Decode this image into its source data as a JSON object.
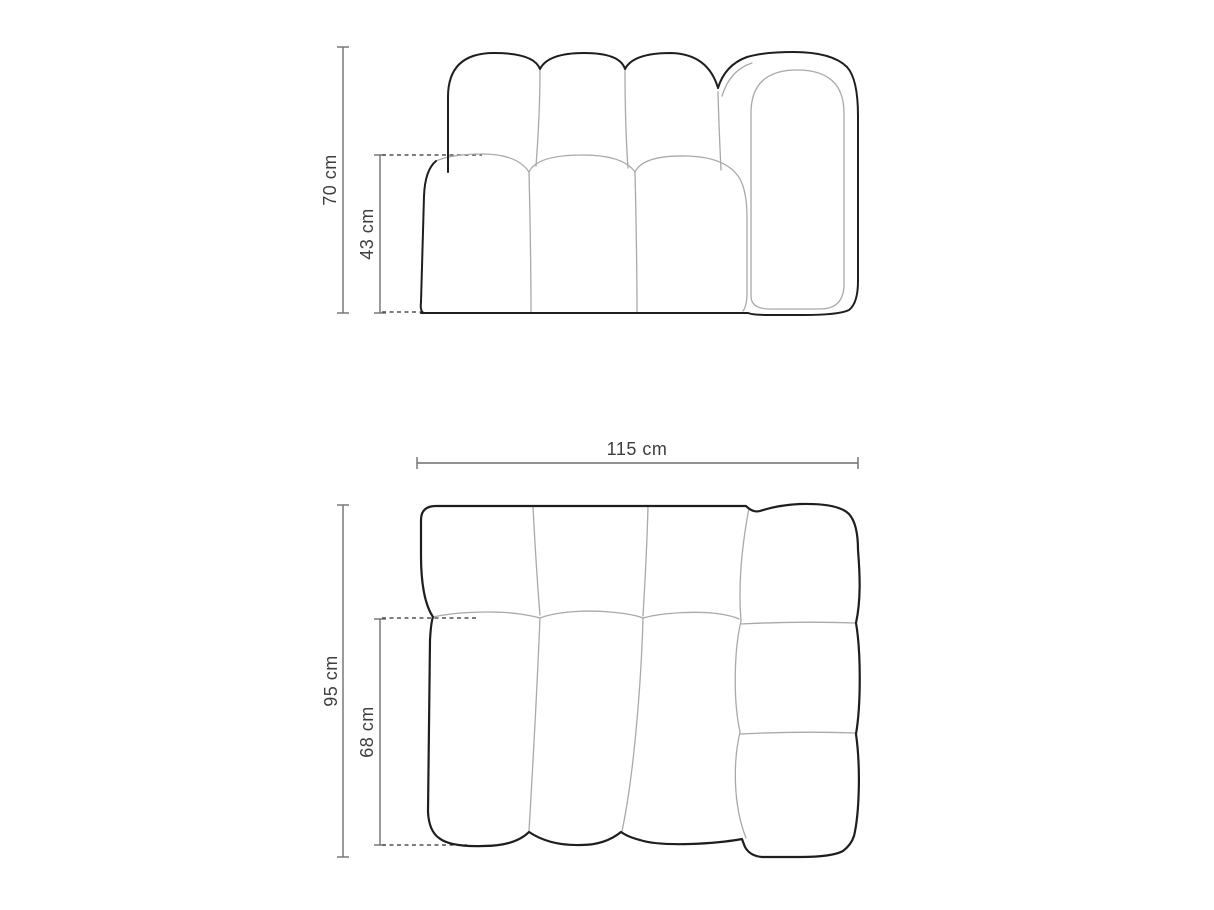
{
  "diagram": {
    "title": "sofa-module-dimension-drawing",
    "views": {
      "front": {
        "name": "front-elevation-view",
        "dimensions": [
          {
            "id": "overall-height",
            "label": "70 cm"
          },
          {
            "id": "seat-height",
            "label": "43 cm"
          }
        ]
      },
      "top": {
        "name": "top-plan-view",
        "dimensions": [
          {
            "id": "overall-width",
            "label": "115 cm"
          },
          {
            "id": "overall-depth",
            "label": "95 cm"
          },
          {
            "id": "seat-depth",
            "label": "68 cm"
          }
        ]
      }
    },
    "colors": {
      "outline_dark": "#1e1e1e",
      "outline_light": "#a9a9a9",
      "dimension_line": "#6f6f6f",
      "extension_dashed": "#525252",
      "label_text": "#3e3e3e",
      "background": "#ffffff"
    }
  }
}
